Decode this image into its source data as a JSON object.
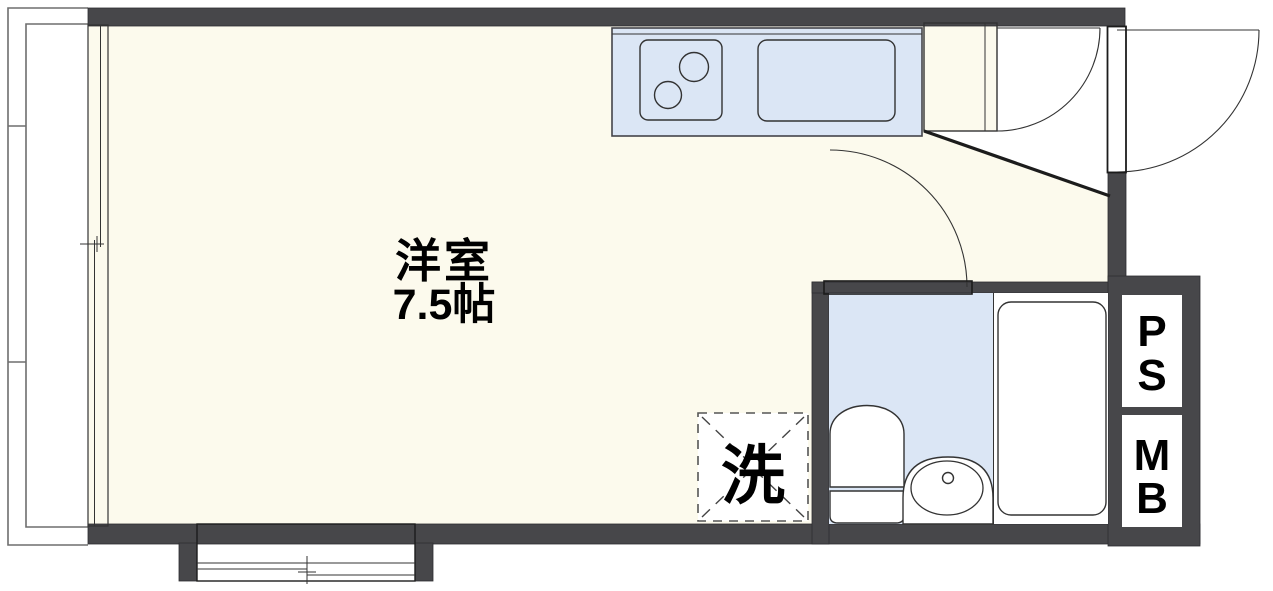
{
  "plan": {
    "room": {
      "name": "洋室",
      "size": "7.5帖"
    },
    "laundry": {
      "label": "洗"
    },
    "pipe_space": {
      "letter_top": "P",
      "letter_bottom": "S"
    },
    "meter_box": {
      "letter_top": "M",
      "letter_bottom": "B"
    },
    "colors": {
      "wall": "#47474a",
      "room_floor": "#fcfaed",
      "fixture_blue": "#dbe6f5",
      "cabinet_beige": "#f7e8d7",
      "outline": "#333333",
      "balcony_line": "#6e6e6e"
    }
  }
}
